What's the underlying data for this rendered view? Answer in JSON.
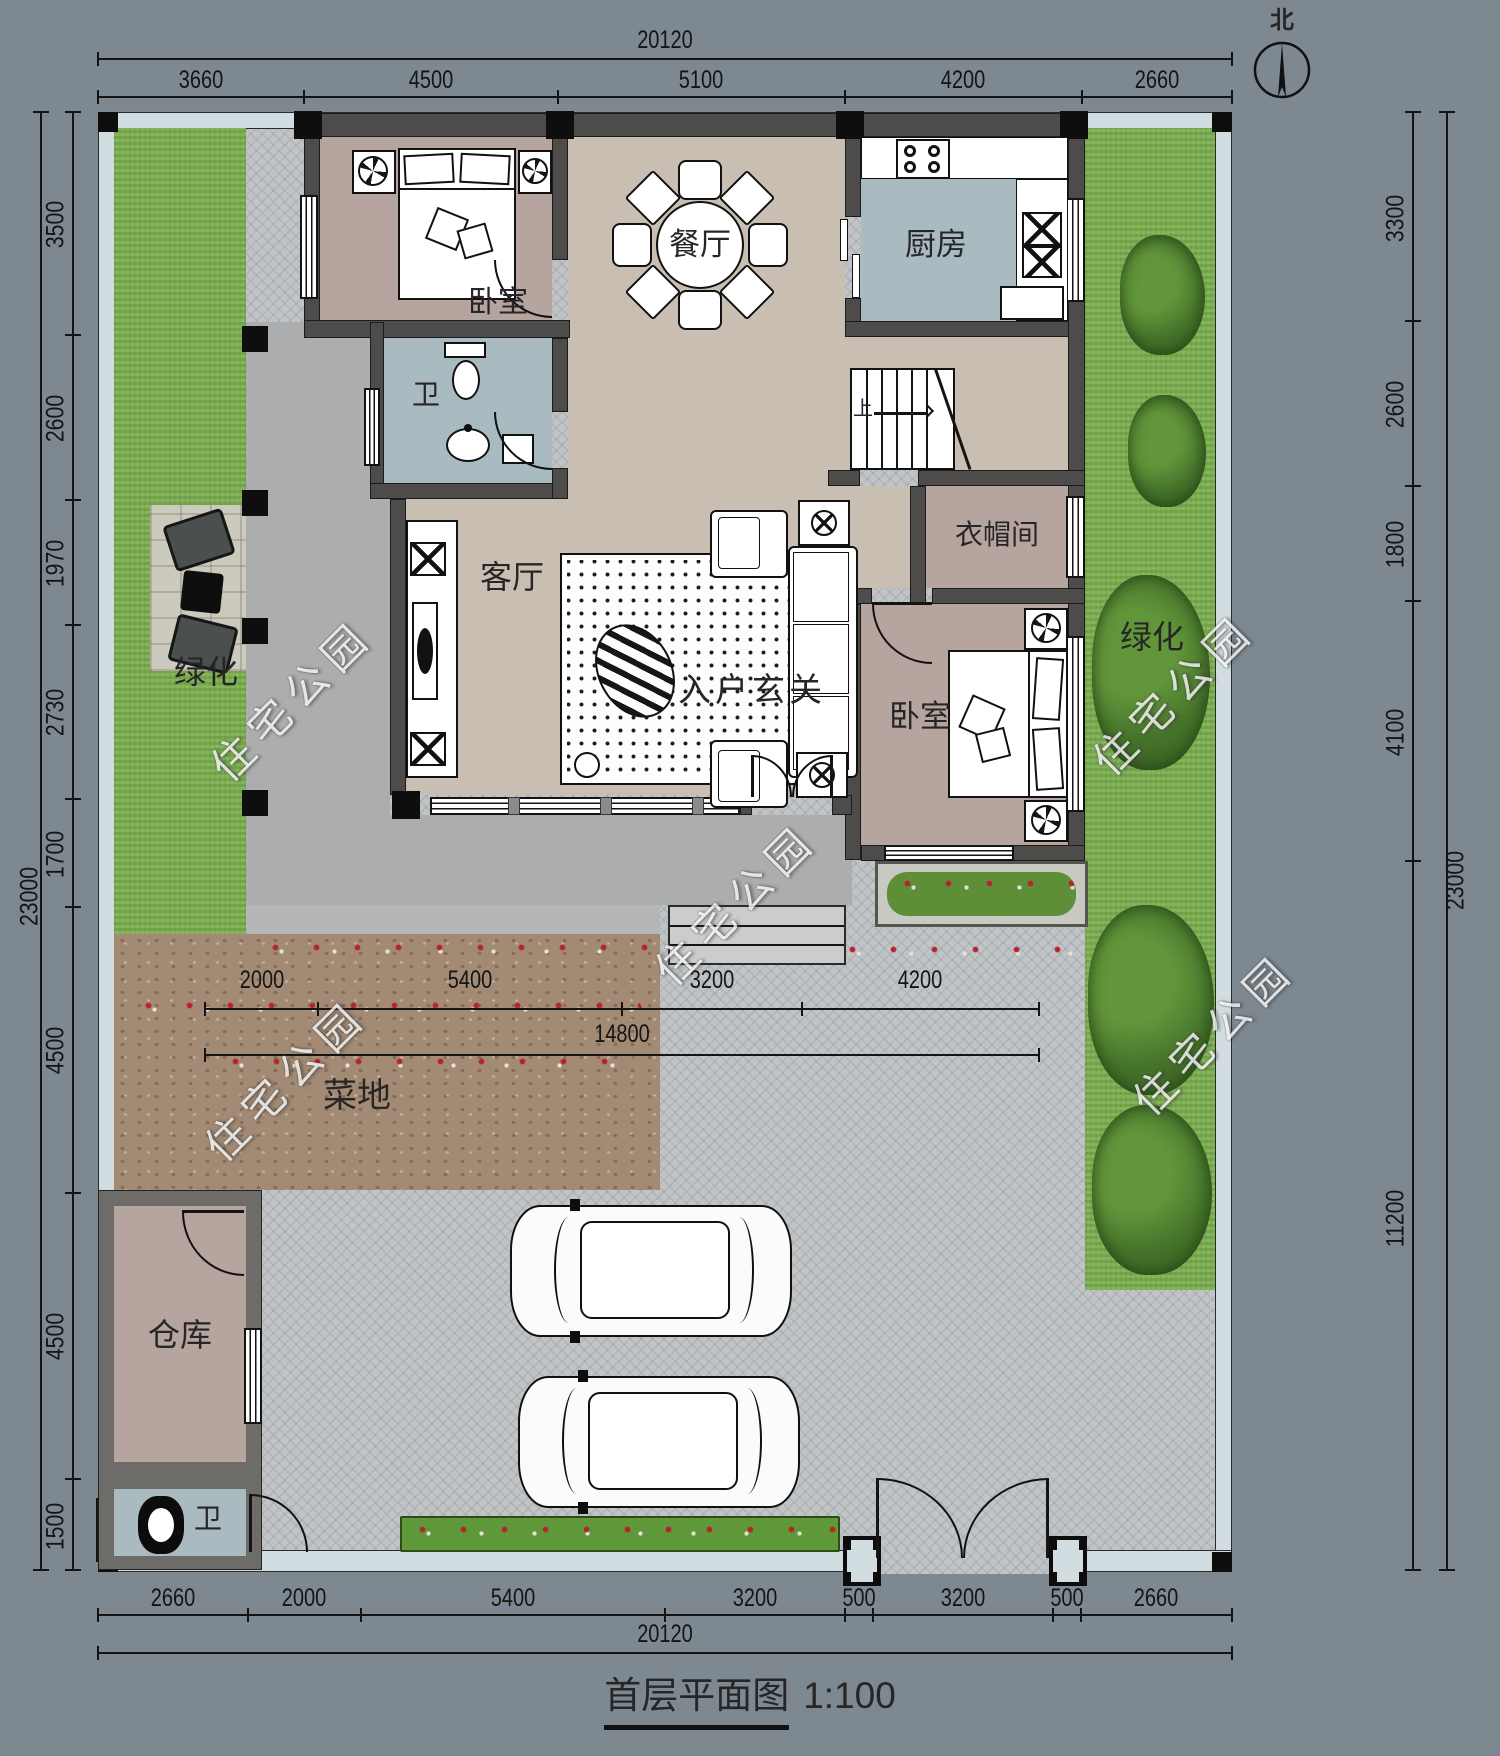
{
  "title": {
    "name": "首层平面图",
    "scale": "1:100"
  },
  "compass": {
    "north": "北"
  },
  "watermark": {
    "text": "住宅公园"
  },
  "rooms": {
    "bedroom1": "卧室",
    "bath1": "卫",
    "dining": "餐厅",
    "kitchen": "厨房",
    "living": "客厅",
    "foyer": "入户玄关",
    "cloakroom": "衣帽间",
    "bedroom2": "卧室",
    "warehouse": "仓库",
    "bath2": "卫",
    "garden": "菜地",
    "green_left": "绿化",
    "green_right": "绿化",
    "stairs_up": "上"
  },
  "dimensions": {
    "top": {
      "total": "20120",
      "segments": [
        "3660",
        "4500",
        "5100",
        "4200",
        "2660"
      ]
    },
    "bottom": {
      "total": "20120",
      "segments": [
        "2660",
        "2000",
        "5400",
        "3200",
        "500",
        "3200",
        "500",
        "2660"
      ]
    },
    "left": {
      "total": "23000",
      "segments": [
        "3500",
        "2600",
        "1970",
        "2730",
        "1700",
        "4500",
        "4500",
        "1500"
      ]
    },
    "right": {
      "total": "23000",
      "segments": [
        "3300",
        "2600",
        "1800",
        "4100",
        "11200"
      ]
    },
    "inner": {
      "total": "14800",
      "segments": [
        "2000",
        "5400",
        "3200",
        "4200"
      ]
    }
  }
}
